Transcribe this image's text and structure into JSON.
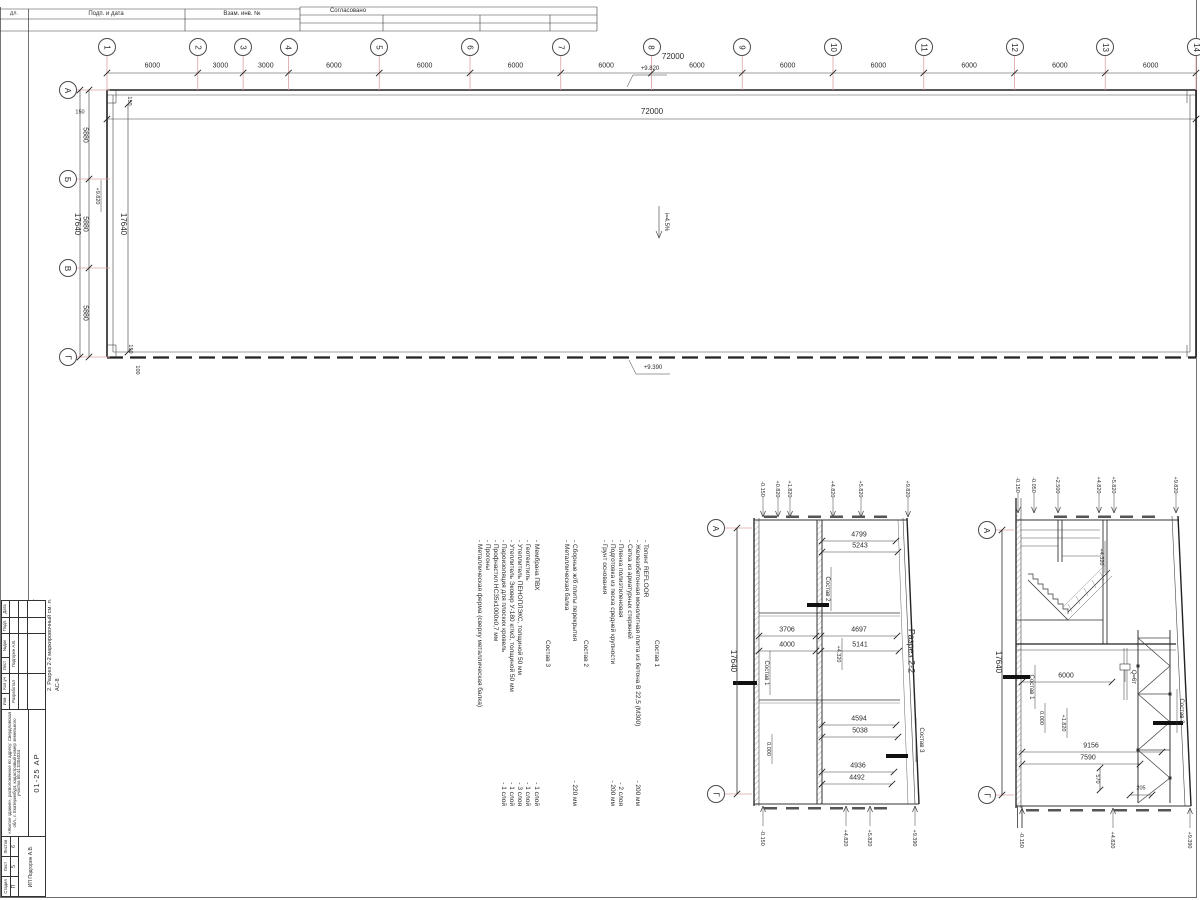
{
  "sheet": {
    "top_strip": {
      "cell_small": "дл.",
      "cell_date": "Подп. и дата",
      "cell_inv": "Взам. инв. №",
      "approved": "Согласовано"
    },
    "side_notes": [
      "1. Разрез 1-1 маркировочный см. л. АС-8",
      "2. Разрез 2-2 маркировочный см. л. АС-8"
    ],
    "stamp": {
      "rev_header": [
        "Изм",
        "Кол.уч",
        "Лист",
        "№док",
        "Подп.",
        "Дата"
      ],
      "role": "Разработал",
      "role_name": "Подгорин А.В.",
      "project_text": "«Жилое здание», расположенное по адресу: Свердловская обл., г. Екатеринбург, кадастровый номер земельного участка 66:41:0304034",
      "doc_code": "01-25 АР",
      "stage_label": "Стадия",
      "sheet_label": "Лист",
      "sheets_label": "Листов",
      "stage": "П",
      "sheet_no": "5",
      "sheets_total": "6",
      "company": "ИП Подгорин А.В."
    }
  },
  "plan": {
    "column_axes": {
      "labels": [
        "1",
        "2",
        "3",
        "4",
        "5",
        "6",
        "7",
        "8",
        "9",
        "10",
        "11",
        "12",
        "13",
        "14"
      ],
      "spacings": [
        "6000",
        "3000",
        "3000",
        "6000",
        "6000",
        "6000",
        "6000",
        "6000",
        "6000",
        "6000",
        "6000",
        "6000",
        "6000"
      ],
      "total": "72000",
      "total_inner": "72000"
    },
    "row_axes": {
      "labels": [
        "А",
        "Б",
        "В",
        "Г"
      ],
      "spacings": [
        "5880",
        "5880",
        "5880"
      ],
      "total": "17640",
      "total_inner": "17640"
    },
    "offsets": {
      "top": "150",
      "wall_top": "150",
      "wall_bottom": "150",
      "bottom_gap": "100"
    },
    "elevations": {
      "top": "+9.820",
      "bottom": "+9.390",
      "left": "+9.820"
    },
    "slope": "i=4.5%"
  },
  "section22": {
    "title": "Разрез 2-2",
    "axis_top": "А",
    "axis_bottom": "Г",
    "height_total": "17640",
    "dims": {
      "d4799": "4799",
      "d5243": "5243",
      "d3706": "3706",
      "d4000": "4000",
      "d4697": "4697",
      "d5141": "5141",
      "d4594": "4594",
      "d5038": "5038",
      "d4936": "4936",
      "d4492": "4492"
    },
    "elev_top": [
      "-0.150",
      "+0.820",
      "+1.820",
      "+4.820",
      "+5.820",
      "+9.820"
    ],
    "elev_bottom": [
      "-0.150",
      "+4.820",
      "+5.820",
      "+9.390"
    ],
    "labels": {
      "sostav1": "Состав 1",
      "sostav2": "Состав 2",
      "sostav3": "Состав 3",
      "lvl4320": "+4.320",
      "lvl0": "0.000"
    }
  },
  "section11": {
    "axis_top": "А",
    "axis_bottom": "Г",
    "height_total": "17640",
    "dims": {
      "d6000": "6000",
      "d9156": "9156",
      "d7590": "7590",
      "d570": "570",
      "d205": "205"
    },
    "elev_top": [
      "-0.150",
      "-0.050",
      "+2.500",
      "+4.820",
      "+5.820",
      "+9.820"
    ],
    "elev_bottom": [
      "-0.150",
      "+4.820",
      "+9.390"
    ],
    "labels": {
      "sostav1": "Состав 1",
      "sostav3": "Состав 3",
      "lvl4320": "+4.320",
      "lvl0": "0.000",
      "lvl1820": "+1.820",
      "crane": "Q=6т"
    }
  },
  "notes": {
    "groups": [
      {
        "title": "Состав 1",
        "items": [
          {
            "t": "- Топинг REFLOOR",
            "v": ""
          },
          {
            "t": "- Железобетонная монолитная плита из бетона В 22,5 (М300)",
            "v": "- 200 мм"
          },
          {
            "t": "- Сетка из арматурных стержней",
            "v": ""
          },
          {
            "t": "- Пленка полиэтиленовая",
            "v": "- 2 слоя"
          },
          {
            "t": "- Подготовка из песка средней крупности",
            "v": "- 200 мм"
          },
          {
            "t": "- Грунт основания",
            "v": ""
          }
        ]
      },
      {
        "title": "Состав 2",
        "items": [
          {
            "t": "- Сборные ж/б плиты перекрытия",
            "v": "- 220 мм"
          },
          {
            "t": "- Металлическая балка",
            "v": ""
          }
        ]
      },
      {
        "title": "Состав 3",
        "items": [
          {
            "t": "- Мембрана ПВХ",
            "v": "- 1 слой"
          },
          {
            "t": "- Геотекстиль",
            "v": "- 1 слой"
          },
          {
            "t": "- Утеплитель ПЕНОПЛЭКС, толщиной 50 мм",
            "v": "- 3 слоя"
          },
          {
            "t": "- Утеплитель Эковер У-180 кг/м3, толщиной 50 мм",
            "v": "- 1 слой"
          },
          {
            "t": "- Пароизоляция для плоских кровель",
            "v": "- 1 слой"
          },
          {
            "t": "- Профнастил НС35х1000х0,7 мм",
            "v": ""
          },
          {
            "t": "- Прогоны",
            "v": ""
          },
          {
            "t": "- Металлическая ферма (сверху металлическая балка)",
            "v": ""
          }
        ]
      }
    ]
  },
  "colors": {
    "axis_line": "#dca0a0",
    "line": "#3a3a3a",
    "wall": "#222222"
  }
}
